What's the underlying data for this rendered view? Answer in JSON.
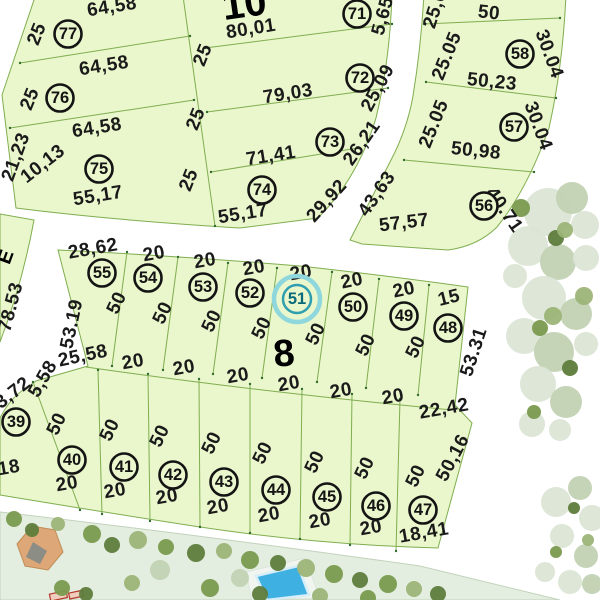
{
  "blocks": {
    "block_10": {
      "label": "10"
    },
    "block_8": {
      "label": "8"
    }
  },
  "street_label": {
    "text": "E"
  },
  "selected_lot": {
    "number": "51",
    "x": 297,
    "y": 299
  },
  "colors": {
    "parcel": "#eaf6cc",
    "parcel_line": "#7fae4f",
    "vertex_dot": "#2f6b2c",
    "dim_text": "#1a1a1a",
    "lot_ring": "#141414",
    "block_label": "#1b67b0",
    "highlight_outer": "#8ed7dd",
    "highlight_inner": "#2f9fb0",
    "highlight_text": "#0b6b7a",
    "park": "#e4eee0",
    "park_edge": "#c2d3bb",
    "pool": "#3fb0e2",
    "pool_edge": "#d7edf8",
    "deck": "#f1f5f0",
    "gazebo": "#dda777",
    "gazebo_edge": "#c08c55",
    "gazebo_shadow": "#8c8d85",
    "kiosk_fill": "#f0cdbd",
    "kiosk_edge": "#b4382c",
    "tree_pale": "#dbe5d5",
    "tree_sage": "#c2d2b3",
    "tree_green": "#9cb477",
    "tree_olive": "#7a9a4e",
    "tree_dark": "#5e7c3c"
  },
  "lot_markers": [
    {
      "n": "77",
      "x": 68,
      "y": 34
    },
    {
      "n": "76",
      "x": 60,
      "y": 98
    },
    {
      "n": "75",
      "x": 99,
      "y": 169
    },
    {
      "n": "71",
      "x": 357,
      "y": 14
    },
    {
      "n": "72",
      "x": 360,
      "y": 78
    },
    {
      "n": "73",
      "x": 330,
      "y": 142
    },
    {
      "n": "74",
      "x": 262,
      "y": 190
    },
    {
      "n": "58",
      "x": 520,
      "y": 54
    },
    {
      "n": "57",
      "x": 514,
      "y": 127
    },
    {
      "n": "56",
      "x": 484,
      "y": 206
    },
    {
      "n": "55",
      "x": 102,
      "y": 273
    },
    {
      "n": "54",
      "x": 148,
      "y": 278
    },
    {
      "n": "53",
      "x": 203,
      "y": 287
    },
    {
      "n": "52",
      "x": 250,
      "y": 293
    },
    {
      "n": "50",
      "x": 353,
      "y": 307
    },
    {
      "n": "49",
      "x": 404,
      "y": 316
    },
    {
      "n": "48",
      "x": 448,
      "y": 328
    },
    {
      "n": "39",
      "x": 16,
      "y": 422
    },
    {
      "n": "40",
      "x": 72,
      "y": 460
    },
    {
      "n": "41",
      "x": 124,
      "y": 467
    },
    {
      "n": "42",
      "x": 173,
      "y": 475
    },
    {
      "n": "43",
      "x": 224,
      "y": 482
    },
    {
      "n": "44",
      "x": 276,
      "y": 490
    },
    {
      "n": "45",
      "x": 327,
      "y": 497
    },
    {
      "n": "46",
      "x": 376,
      "y": 506
    },
    {
      "n": "47",
      "x": 423,
      "y": 510
    }
  ],
  "dimension_labels": [
    {
      "t": "64,58",
      "x": 112,
      "y": 7,
      "r": -9
    },
    {
      "t": "25",
      "x": 37,
      "y": 34,
      "r": -68
    },
    {
      "t": "64,58",
      "x": 104,
      "y": 66,
      "r": -9
    },
    {
      "t": "25",
      "x": 30,
      "y": 99,
      "r": -68
    },
    {
      "t": "64,58",
      "x": 97,
      "y": 128,
      "r": -9
    },
    {
      "t": "21,23",
      "x": 16,
      "y": 157,
      "r": -70
    },
    {
      "t": "10,13",
      "x": 43,
      "y": 164,
      "r": -38
    },
    {
      "t": "55,17",
      "x": 98,
      "y": 196,
      "r": -9
    },
    {
      "t": "25",
      "x": 203,
      "y": 55,
      "r": -68
    },
    {
      "t": "25",
      "x": 196,
      "y": 119,
      "r": -68
    },
    {
      "t": "25",
      "x": 189,
      "y": 180,
      "r": -68
    },
    {
      "t": "80,01",
      "x": 251,
      "y": 29,
      "r": -9
    },
    {
      "t": "79,03",
      "x": 288,
      "y": 94,
      "r": -9
    },
    {
      "t": "71,41",
      "x": 271,
      "y": 156,
      "r": -9
    },
    {
      "t": "55,17",
      "x": 243,
      "y": 214,
      "r": -9
    },
    {
      "t": "5,65",
      "x": 383,
      "y": 16,
      "r": -75
    },
    {
      "t": "25,09",
      "x": 378,
      "y": 88,
      "r": -62
    },
    {
      "t": "26,21",
      "x": 362,
      "y": 143,
      "r": -55
    },
    {
      "t": "29,92",
      "x": 327,
      "y": 201,
      "r": -48
    },
    {
      "t": "43,63",
      "x": 377,
      "y": 194,
      "r": -55
    },
    {
      "t": "57,57",
      "x": 404,
      "y": 223,
      "r": -7
    },
    {
      "t": "50",
      "x": 489,
      "y": 13,
      "r": 6
    },
    {
      "t": "25,05",
      "x": 437,
      "y": 4,
      "r": -72
    },
    {
      "t": "25.05",
      "x": 447,
      "y": 56,
      "r": -68
    },
    {
      "t": "30.04",
      "x": 549,
      "y": 54,
      "r": 70
    },
    {
      "t": "50,23",
      "x": 492,
      "y": 82,
      "r": 6
    },
    {
      "t": "25.05",
      "x": 434,
      "y": 124,
      "r": -68
    },
    {
      "t": "30.04",
      "x": 538,
      "y": 126,
      "r": 70
    },
    {
      "t": "50,98",
      "x": 476,
      "y": 151,
      "r": 6
    },
    {
      "t": "40.71",
      "x": 504,
      "y": 210,
      "r": 55
    },
    {
      "t": "28,62",
      "x": 93,
      "y": 249,
      "r": -10
    },
    {
      "t": "20",
      "x": 154,
      "y": 254,
      "r": -10
    },
    {
      "t": "20",
      "x": 205,
      "y": 261,
      "r": -10
    },
    {
      "t": "20",
      "x": 254,
      "y": 268,
      "r": -10
    },
    {
      "t": "20",
      "x": 301,
      "y": 273,
      "r": -10
    },
    {
      "t": "20",
      "x": 352,
      "y": 281,
      "r": -12
    },
    {
      "t": "20",
      "x": 404,
      "y": 290,
      "r": -12
    },
    {
      "t": "15",
      "x": 449,
      "y": 298,
      "r": -14
    },
    {
      "t": "50",
      "x": 117,
      "y": 303,
      "r": -65
    },
    {
      "t": "50",
      "x": 163,
      "y": 313,
      "r": -65
    },
    {
      "t": "50",
      "x": 212,
      "y": 321,
      "r": -65
    },
    {
      "t": "50",
      "x": 262,
      "y": 328,
      "r": -65
    },
    {
      "t": "50",
      "x": 316,
      "y": 334,
      "r": -65
    },
    {
      "t": "50",
      "x": 366,
      "y": 345,
      "r": -65
    },
    {
      "t": "50",
      "x": 416,
      "y": 347,
      "r": -65
    },
    {
      "t": "53.31",
      "x": 474,
      "y": 352,
      "r": -72
    },
    {
      "t": "53.19",
      "x": 72,
      "y": 324,
      "r": -78
    },
    {
      "t": "25,58",
      "x": 83,
      "y": 356,
      "r": -12
    },
    {
      "t": "5,58",
      "x": 43,
      "y": 379,
      "r": -60
    },
    {
      "t": "20",
      "x": 133,
      "y": 362,
      "r": -10
    },
    {
      "t": "20",
      "x": 184,
      "y": 368,
      "r": -10
    },
    {
      "t": "20",
      "x": 238,
      "y": 376,
      "r": -10
    },
    {
      "t": "20",
      "x": 289,
      "y": 384,
      "r": -10
    },
    {
      "t": "20",
      "x": 341,
      "y": 391,
      "r": -10
    },
    {
      "t": "20",
      "x": 393,
      "y": 397,
      "r": -10
    },
    {
      "t": "22,42",
      "x": 444,
      "y": 409,
      "r": -10
    },
    {
      "t": "3,72",
      "x": 13,
      "y": 393,
      "r": -38
    },
    {
      "t": "18",
      "x": 9,
      "y": 468,
      "r": -10
    },
    {
      "t": "50",
      "x": 57,
      "y": 424,
      "r": -65
    },
    {
      "t": "50",
      "x": 110,
      "y": 430,
      "r": -65
    },
    {
      "t": "50",
      "x": 160,
      "y": 436,
      "r": -65
    },
    {
      "t": "50",
      "x": 212,
      "y": 443,
      "r": -65
    },
    {
      "t": "50",
      "x": 263,
      "y": 453,
      "r": -65
    },
    {
      "t": "50",
      "x": 315,
      "y": 462,
      "r": -65
    },
    {
      "t": "50",
      "x": 365,
      "y": 468,
      "r": -65
    },
    {
      "t": "50",
      "x": 416,
      "y": 476,
      "r": -65
    },
    {
      "t": "50,16",
      "x": 453,
      "y": 458,
      "r": -62
    },
    {
      "t": "20",
      "x": 67,
      "y": 484,
      "r": -10
    },
    {
      "t": "20",
      "x": 115,
      "y": 491,
      "r": -10
    },
    {
      "t": "20",
      "x": 167,
      "y": 497,
      "r": -10
    },
    {
      "t": "20",
      "x": 218,
      "y": 507,
      "r": -10
    },
    {
      "t": "20",
      "x": 269,
      "y": 515,
      "r": -10
    },
    {
      "t": "20",
      "x": 320,
      "y": 521,
      "r": -10
    },
    {
      "t": "20",
      "x": 371,
      "y": 528,
      "r": -10
    },
    {
      "t": "18,41",
      "x": 424,
      "y": 533,
      "r": -10
    },
    {
      "t": "78.53",
      "x": 11,
      "y": 307,
      "r": -75
    }
  ],
  "trees": [
    {
      "x": 548,
      "y": 212,
      "r": 24,
      "c": "pale"
    },
    {
      "x": 572,
      "y": 198,
      "r": 16,
      "c": "sage"
    },
    {
      "x": 585,
      "y": 225,
      "r": 14,
      "c": "pale"
    },
    {
      "x": 528,
      "y": 246,
      "r": 20,
      "c": "pale"
    },
    {
      "x": 558,
      "y": 262,
      "r": 18,
      "c": "sage"
    },
    {
      "x": 586,
      "y": 258,
      "r": 13,
      "c": "pale"
    },
    {
      "x": 515,
      "y": 276,
      "r": 12,
      "c": "pale"
    },
    {
      "x": 544,
      "y": 298,
      "r": 22,
      "c": "pale"
    },
    {
      "x": 576,
      "y": 314,
      "r": 16,
      "c": "sage"
    },
    {
      "x": 524,
      "y": 336,
      "r": 18,
      "c": "pale"
    },
    {
      "x": 554,
      "y": 352,
      "r": 20,
      "c": "sage"
    },
    {
      "x": 586,
      "y": 344,
      "r": 12,
      "c": "pale"
    },
    {
      "x": 538,
      "y": 384,
      "r": 18,
      "c": "pale"
    },
    {
      "x": 566,
      "y": 402,
      "r": 16,
      "c": "sage"
    },
    {
      "x": 532,
      "y": 424,
      "r": 13,
      "c": "pale"
    },
    {
      "x": 560,
      "y": 430,
      "r": 11,
      "c": "pale"
    },
    {
      "x": 521,
      "y": 208,
      "r": 9,
      "c": "olive"
    },
    {
      "x": 556,
      "y": 238,
      "r": 8,
      "c": "dark"
    },
    {
      "x": 584,
      "y": 296,
      "r": 9,
      "c": "green"
    },
    {
      "x": 540,
      "y": 328,
      "r": 8,
      "c": "olive"
    },
    {
      "x": 570,
      "y": 368,
      "r": 8,
      "c": "dark"
    },
    {
      "x": 534,
      "y": 412,
      "r": 7,
      "c": "olive"
    },
    {
      "x": 553,
      "y": 316,
      "r": 9,
      "c": "green"
    },
    {
      "x": 565,
      "y": 230,
      "r": 8,
      "c": "green"
    },
    {
      "x": 556,
      "y": 502,
      "r": 15,
      "c": "pale"
    },
    {
      "x": 580,
      "y": 488,
      "r": 12,
      "c": "sage"
    },
    {
      "x": 592,
      "y": 518,
      "r": 13,
      "c": "pale"
    },
    {
      "x": 562,
      "y": 536,
      "r": 12,
      "c": "pale"
    },
    {
      "x": 586,
      "y": 556,
      "r": 12,
      "c": "sage"
    },
    {
      "x": 570,
      "y": 582,
      "r": 12,
      "c": "pale"
    },
    {
      "x": 545,
      "y": 572,
      "r": 10,
      "c": "pale"
    },
    {
      "x": 592,
      "y": 584,
      "r": 10,
      "c": "sage"
    },
    {
      "x": 574,
      "y": 508,
      "r": 6,
      "c": "dark"
    },
    {
      "x": 556,
      "y": 552,
      "r": 6,
      "c": "olive"
    },
    {
      "x": 588,
      "y": 540,
      "r": 6,
      "c": "green"
    }
  ],
  "park_trees": [
    {
      "x": 14,
      "y": 519,
      "r": 8,
      "c": "olive"
    },
    {
      "x": 32,
      "y": 530,
      "r": 7,
      "c": "dark"
    },
    {
      "x": 58,
      "y": 524,
      "r": 7,
      "c": "green"
    },
    {
      "x": 92,
      "y": 534,
      "r": 9,
      "c": "olive"
    },
    {
      "x": 112,
      "y": 545,
      "r": 8,
      "c": "dark"
    },
    {
      "x": 138,
      "y": 540,
      "r": 9,
      "c": "green"
    },
    {
      "x": 166,
      "y": 547,
      "r": 8,
      "c": "olive"
    },
    {
      "x": 196,
      "y": 553,
      "r": 9,
      "c": "dark"
    },
    {
      "x": 224,
      "y": 551,
      "r": 8,
      "c": "green"
    },
    {
      "x": 250,
      "y": 560,
      "r": 9,
      "c": "olive"
    },
    {
      "x": 278,
      "y": 563,
      "r": 8,
      "c": "dark"
    },
    {
      "x": 306,
      "y": 568,
      "r": 9,
      "c": "green"
    },
    {
      "x": 334,
      "y": 574,
      "r": 9,
      "c": "olive"
    },
    {
      "x": 360,
      "y": 580,
      "r": 8,
      "c": "dark"
    },
    {
      "x": 388,
      "y": 584,
      "r": 9,
      "c": "olive"
    },
    {
      "x": 414,
      "y": 589,
      "r": 8,
      "c": "green"
    },
    {
      "x": 62,
      "y": 588,
      "r": 8,
      "c": "olive"
    },
    {
      "x": 86,
      "y": 594,
      "r": 7,
      "c": "dark"
    },
    {
      "x": 132,
      "y": 583,
      "r": 8,
      "c": "green"
    },
    {
      "x": 210,
      "y": 588,
      "r": 9,
      "c": "olive"
    },
    {
      "x": 260,
      "y": 594,
      "r": 8,
      "c": "dark"
    },
    {
      "x": 320,
      "y": 596,
      "r": 8,
      "c": "green"
    },
    {
      "x": 368,
      "y": 598,
      "r": 8,
      "c": "olive"
    },
    {
      "x": 160,
      "y": 570,
      "r": 10,
      "c": "sage"
    },
    {
      "x": 240,
      "y": 578,
      "r": 9,
      "c": "sage"
    },
    {
      "x": 438,
      "y": 594,
      "r": 8,
      "c": "dark"
    }
  ]
}
